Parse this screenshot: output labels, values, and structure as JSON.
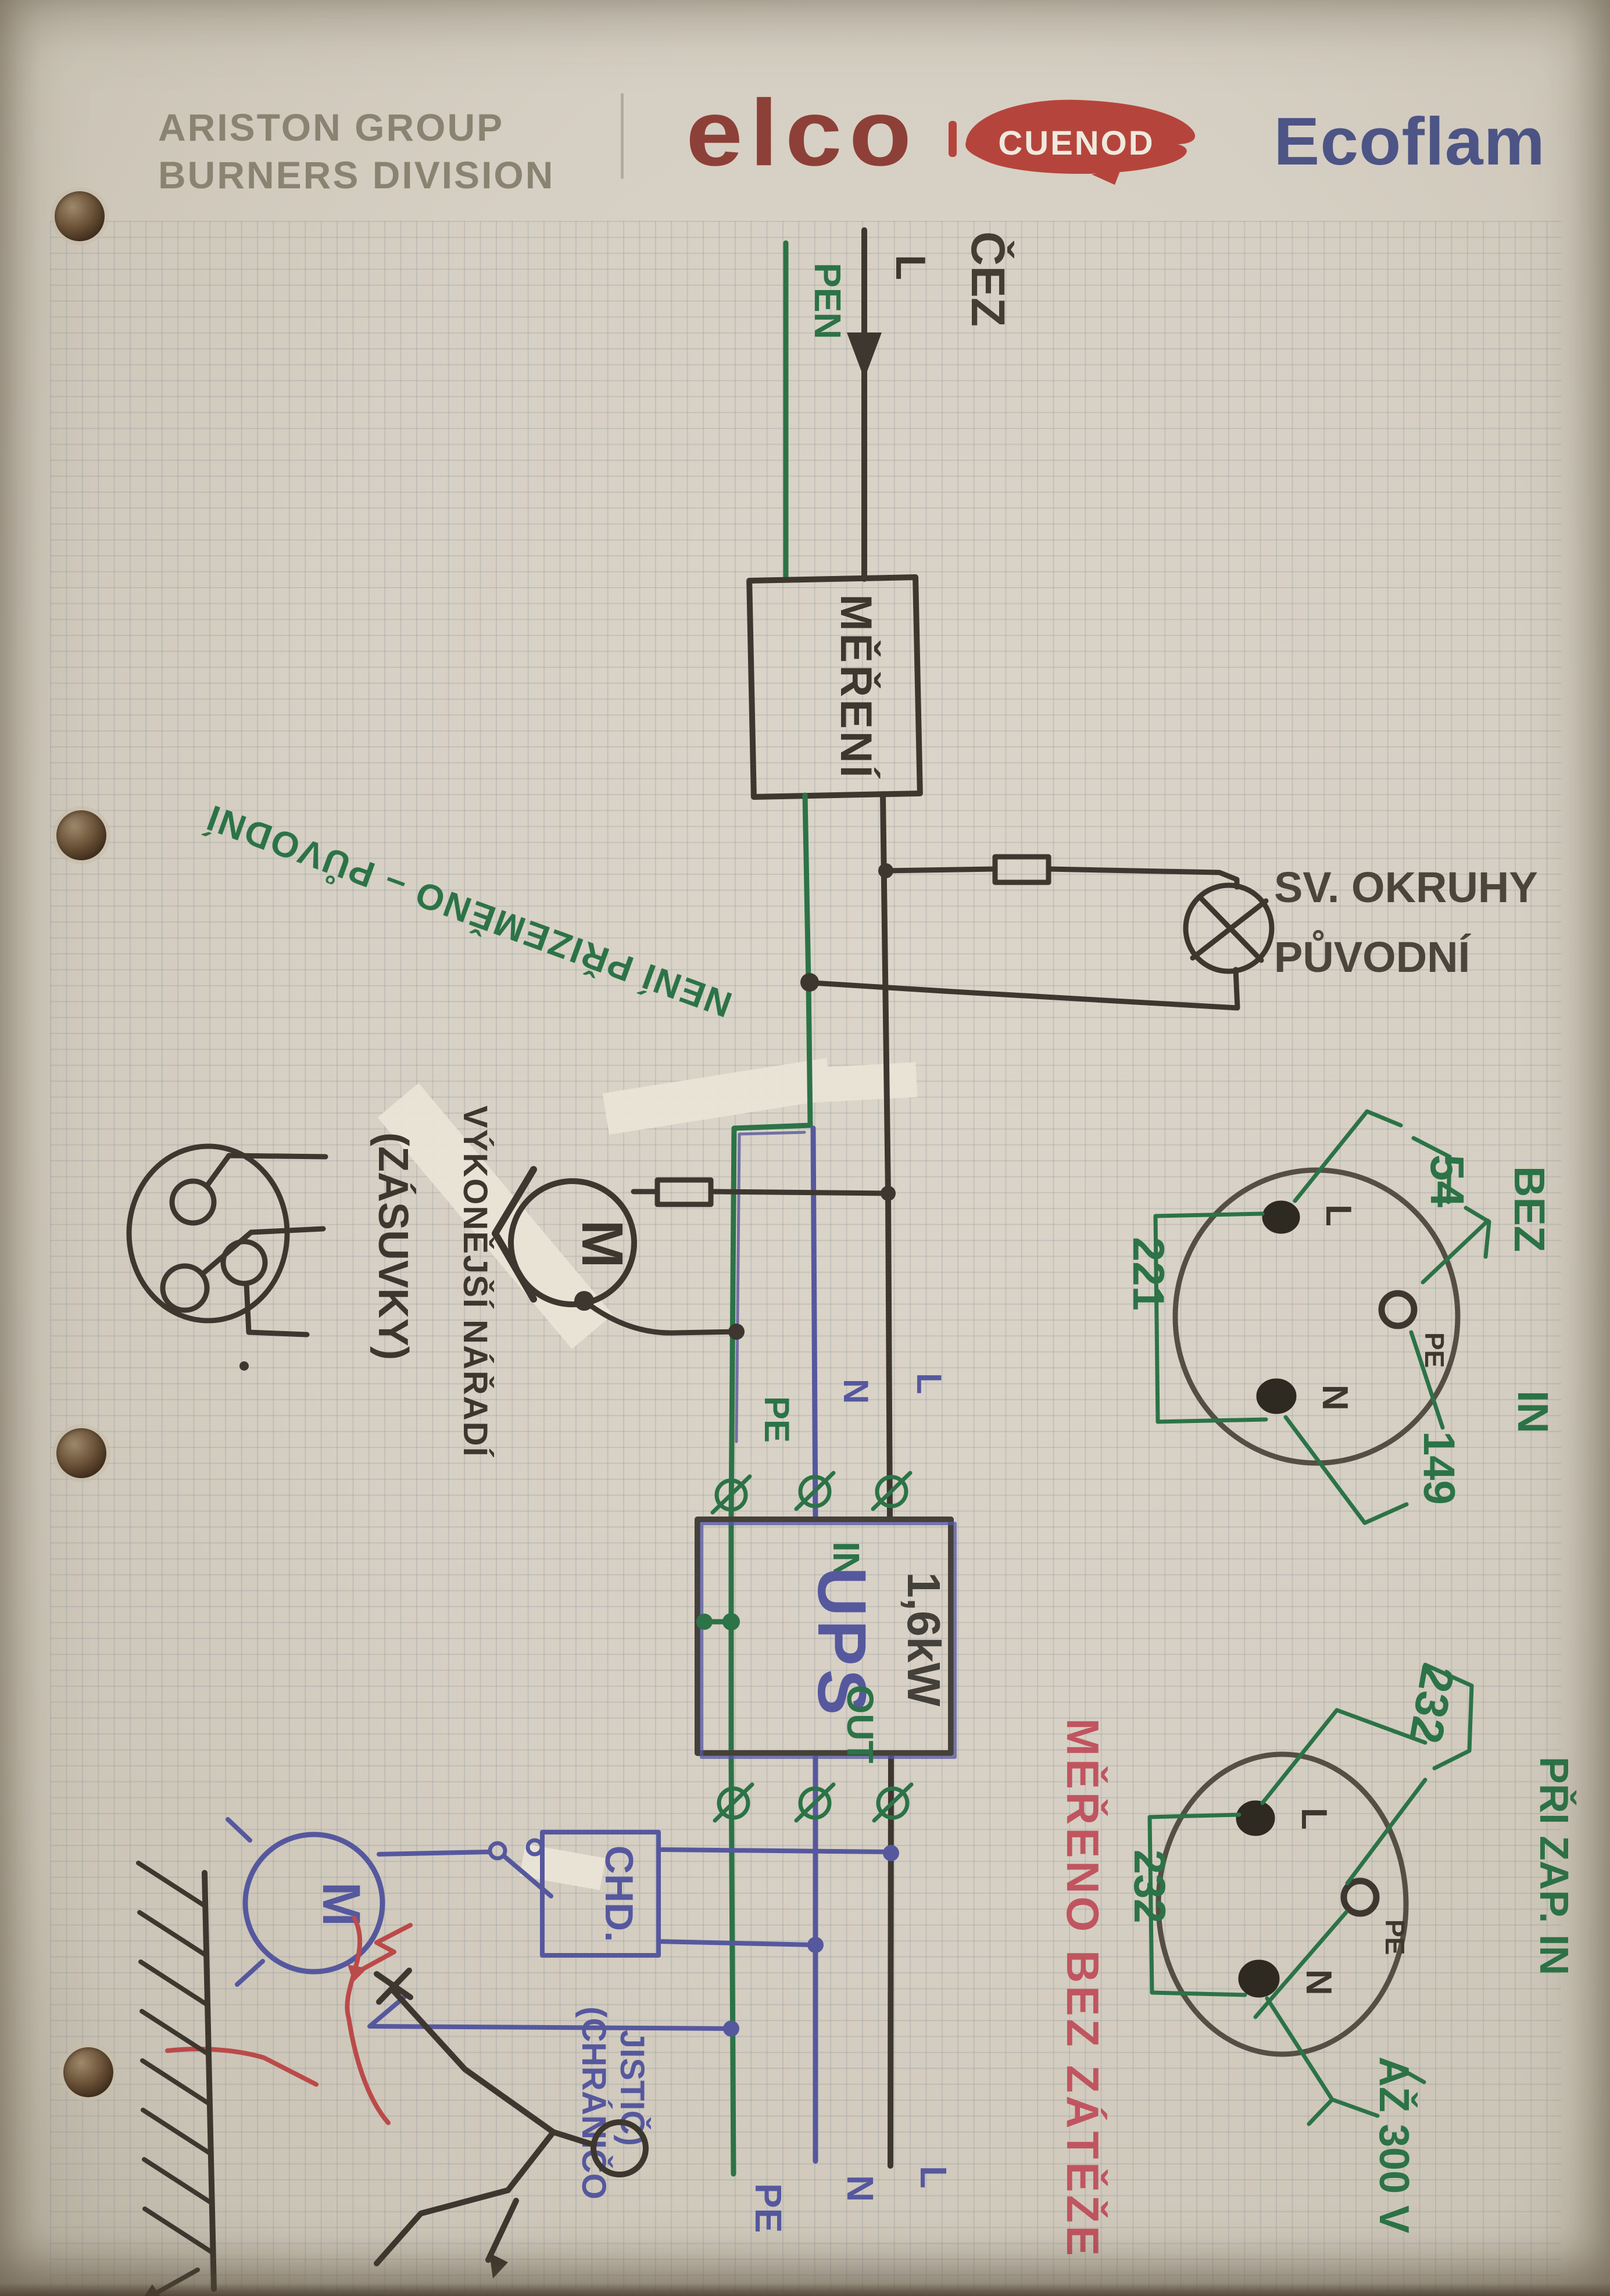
{
  "header": {
    "company_line1": "ARISTON GROUP",
    "company_line2": "BURNERS DIVISION",
    "brand_elco": "elco",
    "brand_cuenod": "CUENOD",
    "brand_ecoflam": "Ecoflam"
  },
  "supply": {
    "pen_label": "PEN",
    "line_label": "L",
    "source_label": "ČEZ"
  },
  "meter_box": {
    "label": "MĚŘENÍ"
  },
  "lamp_branch": {
    "title_line1": "SV. OKRUHY",
    "title_line2": "PŮVODNÍ"
  },
  "notes": {
    "not_grounded": "NENÍ PŘIZEMĚNO – PŮVODNÍ",
    "measured_no_load": "MĚŘENO BEZ ZÁTĚŽE"
  },
  "drill_branch": {
    "label_line1": "VÝKONĚJŠÍ NÁŘADÍ",
    "label_line2": "(ZÁSUVKY)",
    "motor_label": "M"
  },
  "socket_no_load": {
    "l": "L",
    "n": "N",
    "pe": "PE",
    "v_l_pe": "54",
    "v_l_n": "221",
    "v_n_pe": "149",
    "note_line1": "BEZ",
    "note_line2": "IN"
  },
  "ups": {
    "name": "UPS",
    "power": "1,6kW",
    "in_label": "IN",
    "out_label": "OUT"
  },
  "ups_in_wires": {
    "pe": "PE",
    "n": "N",
    "l": "L"
  },
  "rcd": {
    "box_label": "CHD.",
    "note_line1": "(CHRÁNIČO",
    "note_line2": "JISTIČ)",
    "motor_label": "M"
  },
  "socket_loaded": {
    "l": "L",
    "n": "N",
    "pe": "PE",
    "v_top": "232",
    "v_left": "232",
    "note": "PŘI ZAP. IN",
    "max_note": "AŽ 300 V"
  },
  "output_wires": {
    "pe": "PE",
    "n": "N",
    "l": "L"
  },
  "colors": {
    "ink_black": "#3d372f",
    "ink_green": "#2c7347",
    "ink_blue": "#56589e",
    "ink_red": "#bb4a4a",
    "red_text": "#c05560",
    "brand_red": "#b5453c",
    "brand_blue": "#4d5486",
    "header_gray": "#8b8372"
  }
}
